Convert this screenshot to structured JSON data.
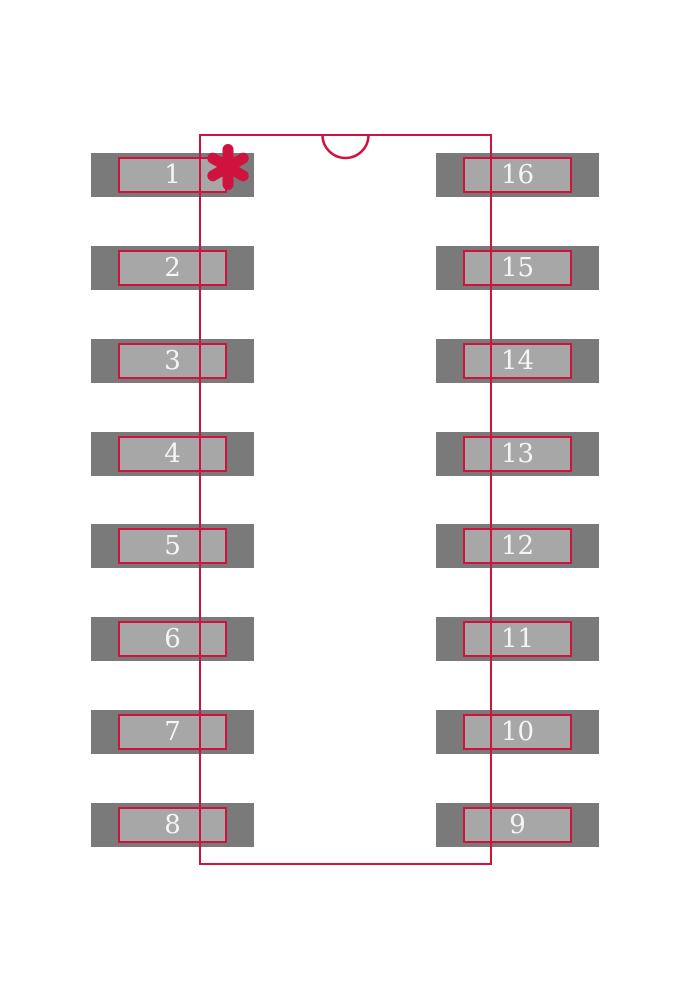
{
  "diagram": {
    "type": "ic-footprint-land-pattern",
    "package_style": "16-pin dual-row package footprint",
    "pin1_marker": "asterisk",
    "orientation_notch": "semicircle at top center of body outline"
  },
  "colors": {
    "background": "#ffffff",
    "outline_red": "#d0123f",
    "pad_outer_gray": "#7a7a7a",
    "pad_inner_gray": "#a7a7a7",
    "pin_number_white": "#f5f5f5"
  },
  "pads": {
    "left": [
      {
        "label": "1"
      },
      {
        "label": "2"
      },
      {
        "label": "3"
      },
      {
        "label": "4"
      },
      {
        "label": "5"
      },
      {
        "label": "6"
      },
      {
        "label": "7"
      },
      {
        "label": "8"
      }
    ],
    "right": [
      {
        "label": "16"
      },
      {
        "label": "15"
      },
      {
        "label": "14"
      },
      {
        "label": "13"
      },
      {
        "label": "12"
      },
      {
        "label": "11"
      },
      {
        "label": "10"
      },
      {
        "label": "9"
      }
    ]
  }
}
